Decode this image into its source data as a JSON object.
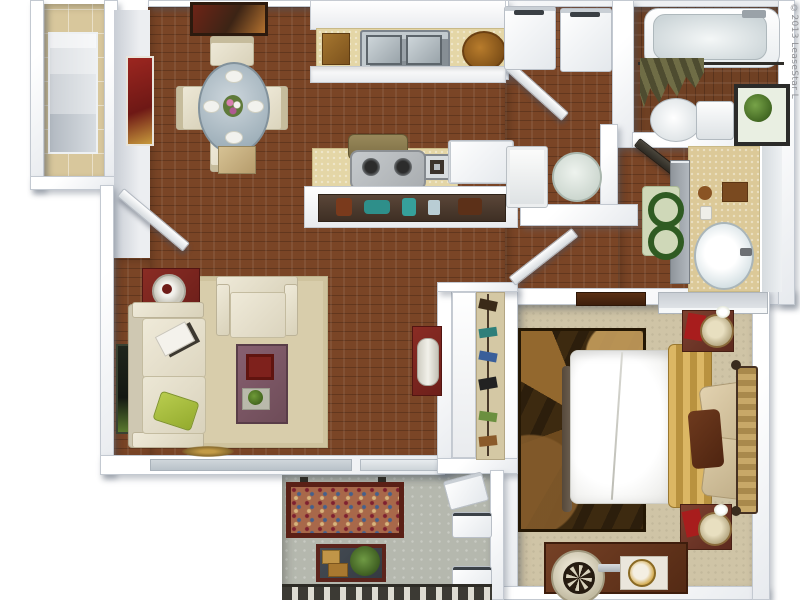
{
  "copyright": "©2013 LeaseStar L",
  "plan": {
    "type": "3d-top-down-floor-plan",
    "description": "one-bedroom one-bath apartment with patio",
    "rooms": [
      {
        "id": "entry-closet",
        "furniture": [
          "shelving-unit"
        ],
        "floor": "tan-tile"
      },
      {
        "id": "dining-area",
        "furniture": [
          "round-glass-table",
          "dining-chair x4",
          "place-setting x4",
          "flower-centerpiece",
          "red-wall-art",
          "dark-painting",
          "wall-shelf"
        ],
        "floor": "wood"
      },
      {
        "id": "kitchen",
        "furniture": [
          "upper-cabinets",
          "double-sink",
          "cutting-board",
          "woven-basket",
          "range-hood",
          "stove-cooktop",
          "prep-sink",
          "refrigerator",
          "display-shelf-decor"
        ],
        "floor": "wood"
      },
      {
        "id": "laundry-closet",
        "furniture": [
          "washer",
          "dryer"
        ],
        "floor": "wood"
      },
      {
        "id": "bathroom",
        "furniture": [
          "bathtub",
          "shower-curtain",
          "curtain-rod",
          "toilet",
          "plant-etagere"
        ],
        "floor": "wood"
      },
      {
        "id": "vanity-area",
        "furniture": [
          "vanity-counter",
          "oval-sink",
          "mirror",
          "vanity-cabinet",
          "bath-rug",
          "toiletries"
        ],
        "floor": "wood"
      },
      {
        "id": "breakfast-nook",
        "furniture": [
          "round-table",
          "bench"
        ],
        "floor": "wood"
      },
      {
        "id": "hall-closet",
        "furniture": [
          "sliding-door",
          "hanging-clothes",
          "red-console-table",
          "lamp"
        ],
        "floor": "wood"
      },
      {
        "id": "living-room",
        "furniture": [
          "sofa",
          "green-pillow",
          "magazines",
          "armchair",
          "area-rug",
          "coffee-table",
          "red-tray",
          "plant-tray",
          "red-side-table",
          "table-lamp",
          "wall-art",
          "floor-medallion",
          "window",
          "sliding-glass-door"
        ],
        "floor": "wood"
      },
      {
        "id": "bedroom",
        "furniture": [
          "bed",
          "white-duvet",
          "gold-throw",
          "pillow x2",
          "accent-pillow",
          "woven-headboard",
          "patterned-rug",
          "nightstand x2",
          "table-lamp x2",
          "dresser",
          "round-fan-mirror",
          "vanity-tray",
          "closet-shelf",
          "media-chest"
        ],
        "floor": "carpet"
      },
      {
        "id": "patio",
        "furniture": [
          "outdoor-bench-floral",
          "outdoor-coffee-table",
          "potted-plant",
          "storage-grill-unit",
          "ac-unit x2",
          "railing"
        ],
        "floor": "concrete"
      }
    ]
  },
  "palette": {
    "wall": "#f4f6f8",
    "wall_edge": "#c3c9d1",
    "wood_floor": "#7a4526",
    "tile_floor": "#d8c79c",
    "carpet": "#cfc4a6",
    "concrete": "#b5b8ae",
    "accent_red": "#7e2420",
    "sofa_cream": "#ebe6d4",
    "coffee_table_mauve": "#7b5763",
    "gold_throw": "#d2ab57",
    "olive_curtain": "#6f6d46",
    "sage_rug": "#cfd8b8",
    "rug_brown_dark": "#3d2a10",
    "lime_pillow": "#a9c13e",
    "counter_tan": "#e4d6a6"
  }
}
